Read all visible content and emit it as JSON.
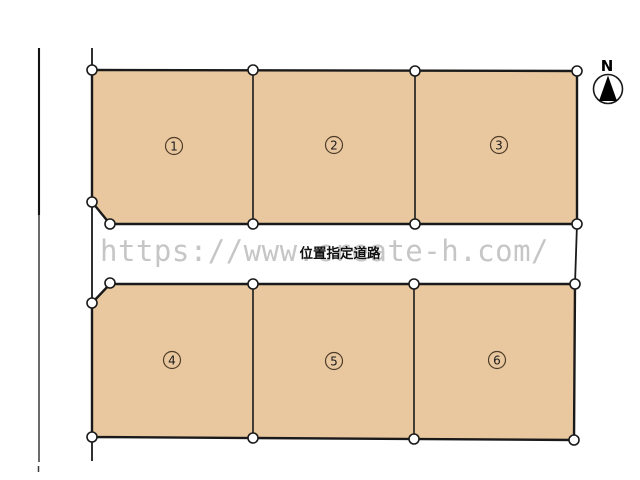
{
  "plots": [
    {
      "number": "1"
    },
    {
      "number": "2"
    },
    {
      "number": "3"
    },
    {
      "number": "4"
    },
    {
      "number": "5"
    },
    {
      "number": "6"
    }
  ],
  "road": {
    "label": "位置指定道路"
  },
  "watermark": {
    "text": "https://www.create-h.com/",
    "color": "#c6c6c6"
  },
  "compass": {
    "label": "N"
  },
  "colors": {
    "plot_fill": "#e9c8a0",
    "outline": "#1a1a1a",
    "vertex_fill": "#ffffff",
    "number_ring": "#4f3d28"
  }
}
